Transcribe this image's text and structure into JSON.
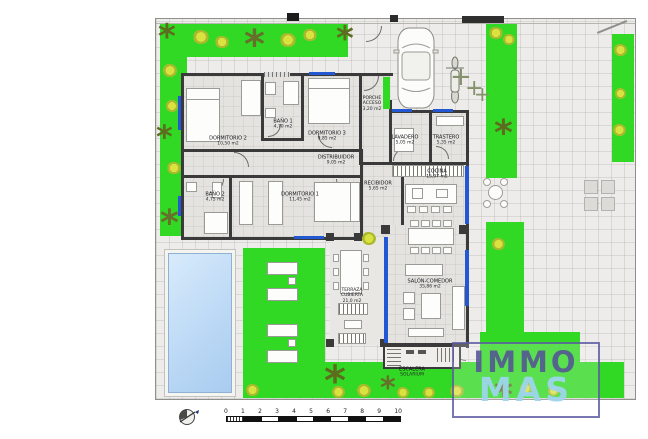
{
  "rooms": {
    "dormitorio2": {
      "name": "DORMITORIO 2",
      "area": "10,50 m2"
    },
    "bano1": {
      "name": "BAÑO 1",
      "area": "4,70 m2"
    },
    "dormitorio3": {
      "name": "DORMITORIO 3",
      "area": "9,85 m2"
    },
    "porche": {
      "name": "PORCHE ACCESO",
      "area": "3,20 m2"
    },
    "lavadero": {
      "name": "LAVADERO",
      "area": "5,05 m2"
    },
    "trastero": {
      "name": "TRASTERO",
      "area": "5,35 m2"
    },
    "distribuidor": {
      "name": "DISTRIBUIDOR",
      "area": "9,05 m2"
    },
    "bano2": {
      "name": "BAÑO 2",
      "area": "4,75 m2"
    },
    "dormitorio1": {
      "name": "DORMITORIO 1",
      "area": "11,45 m2"
    },
    "recibidor": {
      "name": "RECIBIDOR",
      "area": "5,65 m2"
    },
    "cocina": {
      "name": "COCINA",
      "area": "15,97 m2"
    },
    "salon": {
      "name": "SALÓN-COMEDOR",
      "area": "35,86 m2"
    },
    "terraza": {
      "name": "TERRAZA CUBIERTA",
      "area": "21,0 m2"
    },
    "escalera": {
      "name": "ESCALERA",
      "area": "SOLARIUM"
    }
  },
  "logo": {
    "immo": "IMMO",
    "mas": "MAS"
  },
  "scale_bar": {
    "ticks": [
      "0",
      "1",
      "2",
      "3",
      "4",
      "5",
      "6",
      "7",
      "8",
      "9",
      "10"
    ]
  },
  "colors": {
    "grass": "#31d924",
    "pool": "#bcd9f5",
    "wall": "#3a3a3a",
    "window_glass": "#2457d2",
    "logo_immo": "#545296",
    "logo_mas": "#9ed4ec"
  }
}
